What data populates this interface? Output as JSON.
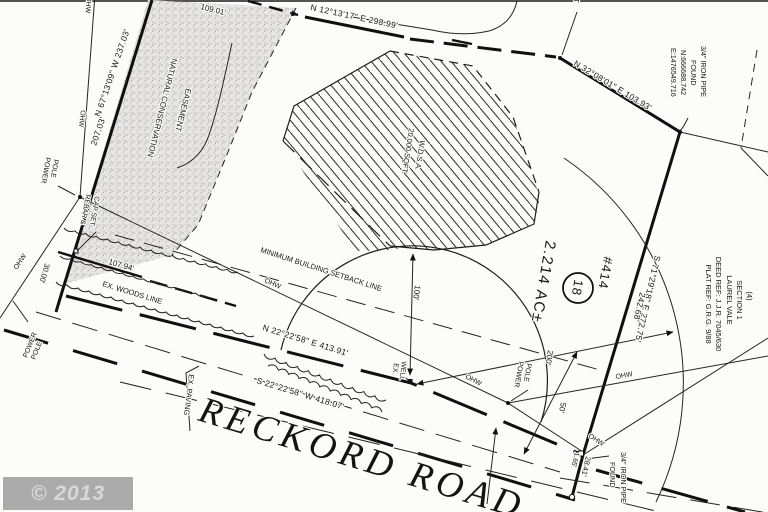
{
  "watermark": {
    "text": "© 2013 MRIS"
  },
  "road": {
    "name": "RECKORD ROAD",
    "frontage_bearing": "N 22°22'58\" E 413.91'",
    "centerline_bearing": "S 22°22'58\" W 418.07'",
    "paving_label": "EX. PAVING"
  },
  "lot": {
    "house_number": "#414",
    "lot_number": "18",
    "area": "2.214 AC±"
  },
  "boundary": {
    "north": {
      "bearing": "N 12°13'17\" E 298.99'"
    },
    "west": {
      "bearing": "N 67°13'09\" W 237.03'",
      "part": "207.03'",
      "top_part": "109.01'",
      "offset": "30.00'"
    },
    "northeast": {
      "bearing": "N 32°08'01\" E 103.93'"
    },
    "east": {
      "bearing": "S 71°29'18\" E 272.75'",
      "part": "242.68'"
    },
    "ties": {
      "tie1": "28.41'",
      "tie2": "1.65'"
    }
  },
  "easement": {
    "line1": "NATURAL CONSERVATION",
    "line2": "EASEMENT"
  },
  "wdsa": {
    "line1": "20,000 SQFT.",
    "line2": "W.D.S.A."
  },
  "setback": {
    "label": "MINIMUM BUILDING SETBACK LINE",
    "radius_100": "100'",
    "radius_200": "200'",
    "pole_dim": "50'"
  },
  "woods": {
    "label": "EX. WOODS LINE",
    "frontage": "107.94'"
  },
  "well": {
    "line1": "EX.",
    "line2": "WELL"
  },
  "power_pole": {
    "line1": "POWER",
    "line2": "POLE"
  },
  "ohw": "OHW",
  "monuments": {
    "rebar": {
      "line1": "REBAR &",
      "line2": "CAP SET"
    },
    "pipe_ne": {
      "line1": "3/4\" IRON PIPE",
      "line2": "FOUND",
      "northing": "N:666688.742",
      "easting": "E:1476549.716"
    },
    "pipe_se": {
      "line1": "3/4\" IRON PIPE",
      "line2": "FOUND"
    },
    "set_partial": "SET"
  },
  "adjacent": {
    "line1": "(4)",
    "line2": "SECTION 1",
    "line3": "LAUREL VALE",
    "line4": "DEED REF: J.J.R. 7045/630",
    "line5": "PLAT REF: G.R.G. 9/88"
  }
}
